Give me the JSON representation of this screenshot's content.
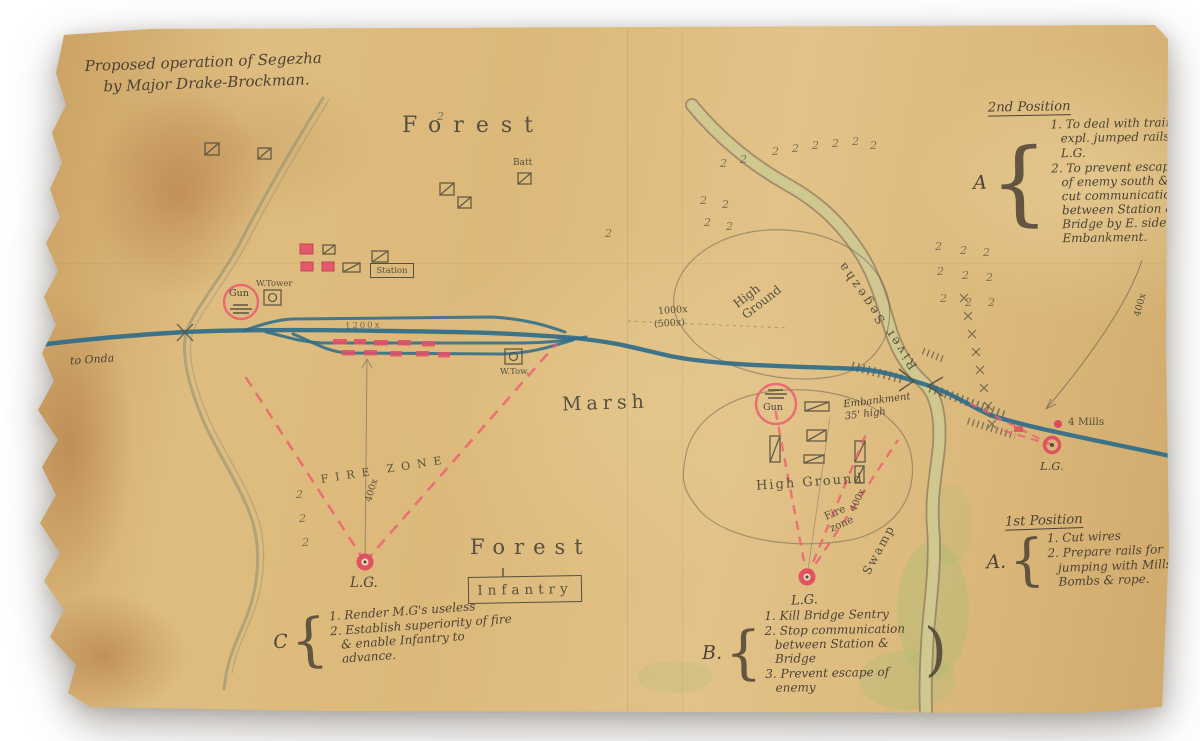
{
  "map": {
    "title": {
      "line1": "Proposed operation of Segezha",
      "line2": "by Major Drake-Brockman."
    },
    "tree_symbol": "2",
    "labels": {
      "forest_top": "Forest",
      "forest_bottom": "Forest",
      "batt": "Batt",
      "station": "Station",
      "w_tower": "W.Tower",
      "w_tow": "W.Tow.",
      "gun_left": "Gun",
      "gun_right": "Gun",
      "to_onda": "to Onda",
      "siding_dist": "1200x",
      "marsh": "Marsh",
      "dist_1000": "1000x",
      "dist_500": "(500x)",
      "high_ground_upper": "High Ground",
      "high_ground_lower": "High Ground",
      "river": "River Segezha",
      "embankment": "Embankment 35' high",
      "fire_zone_left": "FIRE ZONE",
      "fire_zone_right": "Fire zone",
      "dist_400_left": "400x",
      "dist_400_mid": "400x",
      "dist_400_right": "400x",
      "swamp": "Swamp",
      "lg_left": "L.G.",
      "lg_mid": "L.G.",
      "lg_right": "L.G.",
      "four_mills": "4 Mills",
      "infantry": "Infantry"
    },
    "notes": {
      "second_position": {
        "heading": "2nd Position",
        "letter": "A",
        "brace": "{",
        "items": [
          "1. To deal with train, expl. jumped rails & L.G.",
          "2. To prevent escape of enemy south & cut communication between Station & Bridge by E. side of Embankment."
        ]
      },
      "first_position": {
        "heading": "1st Position",
        "letter": "A.",
        "brace": "{",
        "items": [
          "1. Cut wires",
          "2. Prepare rails for jumping with Mills Bombs & rope."
        ]
      },
      "b_tasks": {
        "letter": "B.",
        "brace": "{",
        "brace_close": ")",
        "items": [
          "1. Kill Bridge Sentry",
          "2. Stop communication between Station & Bridge",
          "3. Prevent escape of enemy"
        ]
      },
      "c_tasks": {
        "letter": "C",
        "brace": "{",
        "items": [
          "1. Render M.G's useless",
          "2. Establish superiority of fire & enable Infantry to advance."
        ]
      }
    }
  }
}
